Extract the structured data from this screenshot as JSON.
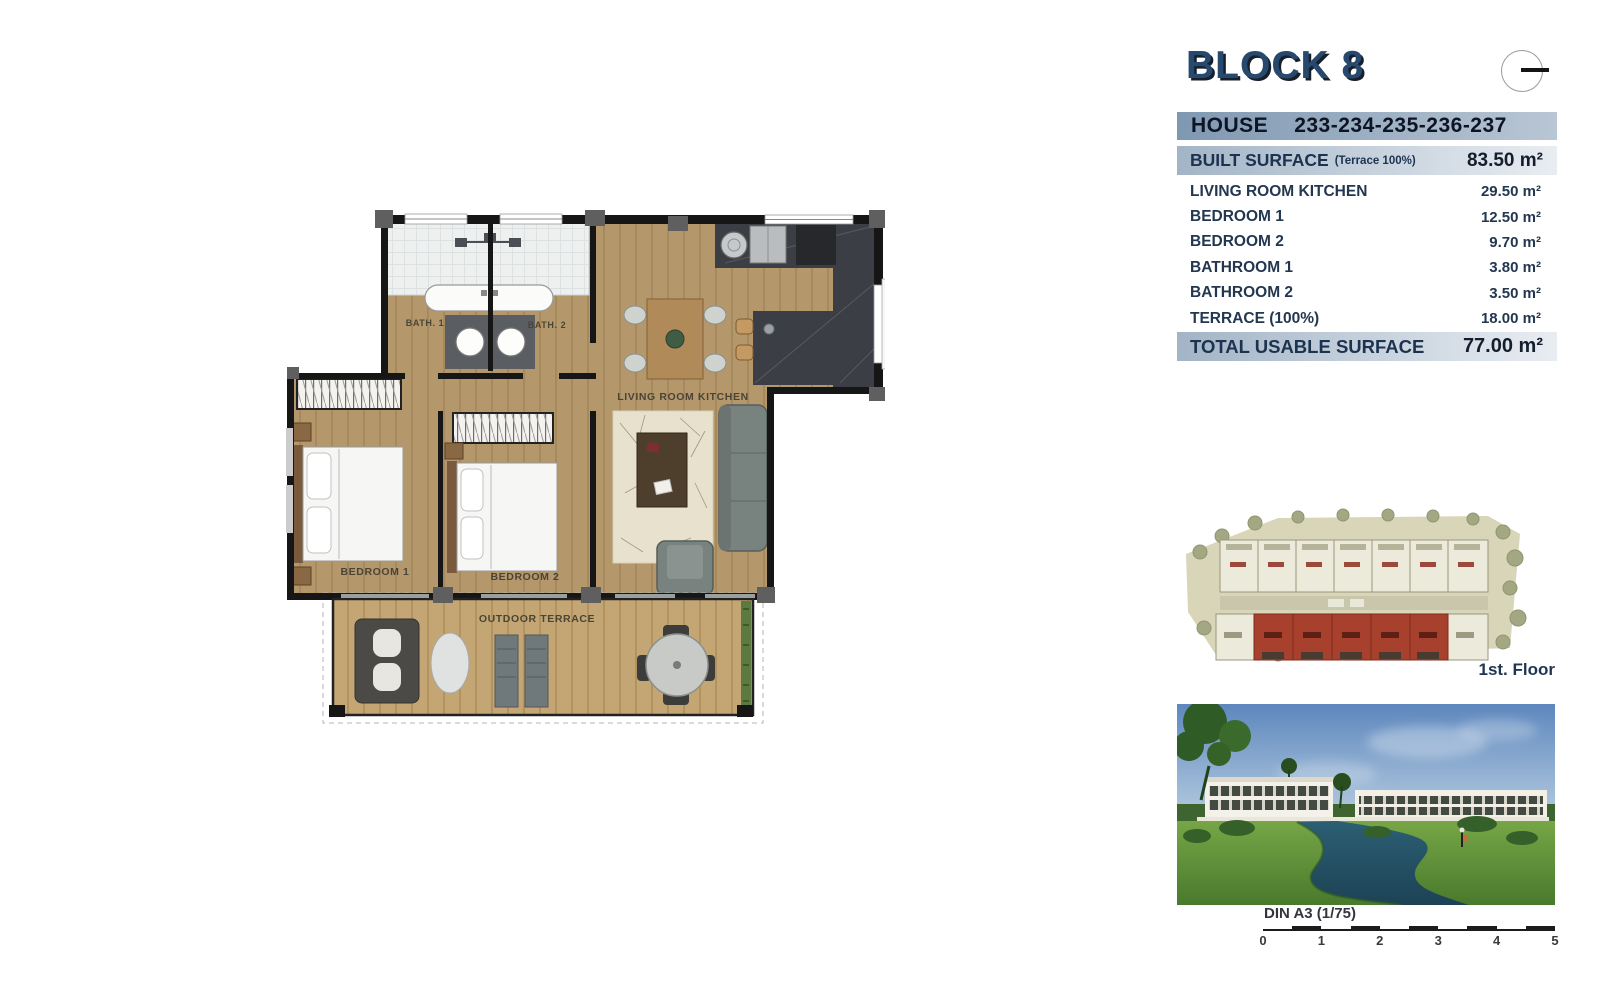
{
  "header": {
    "block_title": "BLOCK 8",
    "house_label": "HOUSE",
    "house_numbers": "233-234-235-236-237"
  },
  "surface_table": {
    "built_label": "BUILT SURFACE",
    "built_note": "(Terrace 100%)",
    "built_value": "83.50 m²",
    "rows": [
      {
        "label": "LIVING ROOM KITCHEN",
        "value": "29.50 m²"
      },
      {
        "label": "BEDROOM 1",
        "value": "12.50 m²"
      },
      {
        "label": "BEDROOM 2",
        "value": "9.70 m²"
      },
      {
        "label": "BATHROOM 1",
        "value": "3.80 m²"
      },
      {
        "label": "BATHROOM 2",
        "value": "3.50 m²"
      },
      {
        "label": "TERRACE (100%)",
        "value": "18.00 m²"
      }
    ],
    "total_label": "TOTAL USABLE SURFACE",
    "total_value": "77.00 m²"
  },
  "floor_plan": {
    "bath1": "BATH. 1",
    "bath2": "BATH. 2",
    "living_room": "LIVING ROOM KITCHEN",
    "bedroom1": "BEDROOM 1",
    "bedroom2": "BEDROOM 2",
    "terrace": "OUTDOOR TERRACE"
  },
  "site_plan": {
    "floor_label": "1st. Floor"
  },
  "scale_bar": {
    "label": "DIN A3 (1/75)",
    "ticks": [
      "0",
      "1",
      "2",
      "3",
      "4",
      "5"
    ]
  },
  "colors": {
    "accent_navy": "#27496e",
    "house_bar": "#8ca3ba",
    "surface_bar": "#c9d3de",
    "wall": "#161616",
    "wood_floor": "#b4986b",
    "terrace_wood": "#c3a673",
    "kitchen_marble": "#3b3f45",
    "site_highlight": "#a8402e"
  }
}
